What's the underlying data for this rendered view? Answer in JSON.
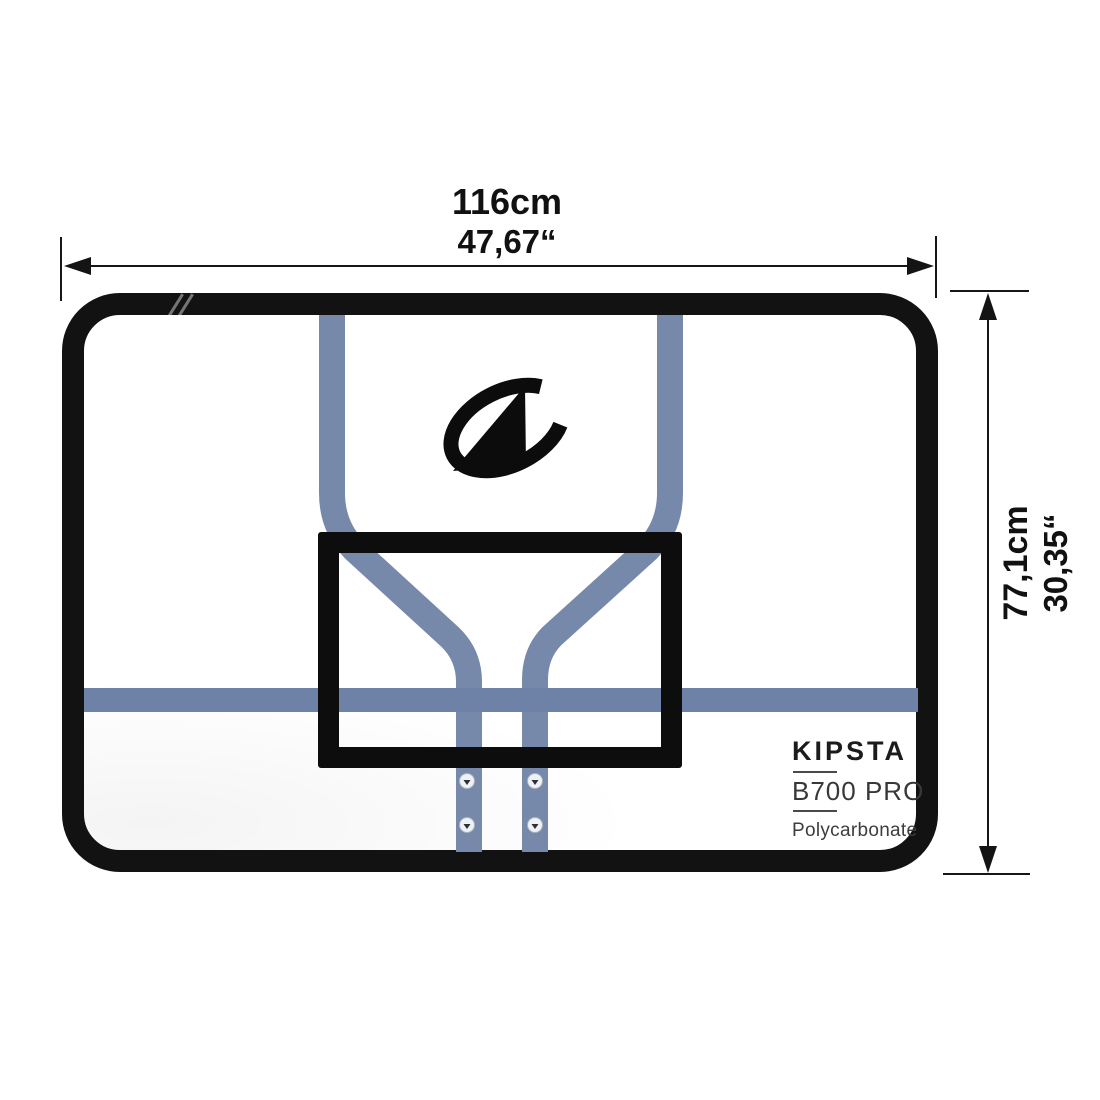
{
  "dimensions": {
    "width": {
      "cm": "116cm",
      "inches": "47,67“"
    },
    "height": {
      "cm": "77,1cm",
      "inches": "30,35“"
    }
  },
  "product_label": {
    "brand": "KIPSTA",
    "model": "B700 PRO",
    "material": "Polycarbonate"
  },
  "logo": {
    "name": "tarmak-swoosh-logo"
  },
  "colors": {
    "frame_black": "#121212",
    "target_square_black": "#0d0d0d",
    "strut_blue": "#7689ab",
    "band_blue": "#6d82a6",
    "dimension_text": "#111111"
  }
}
